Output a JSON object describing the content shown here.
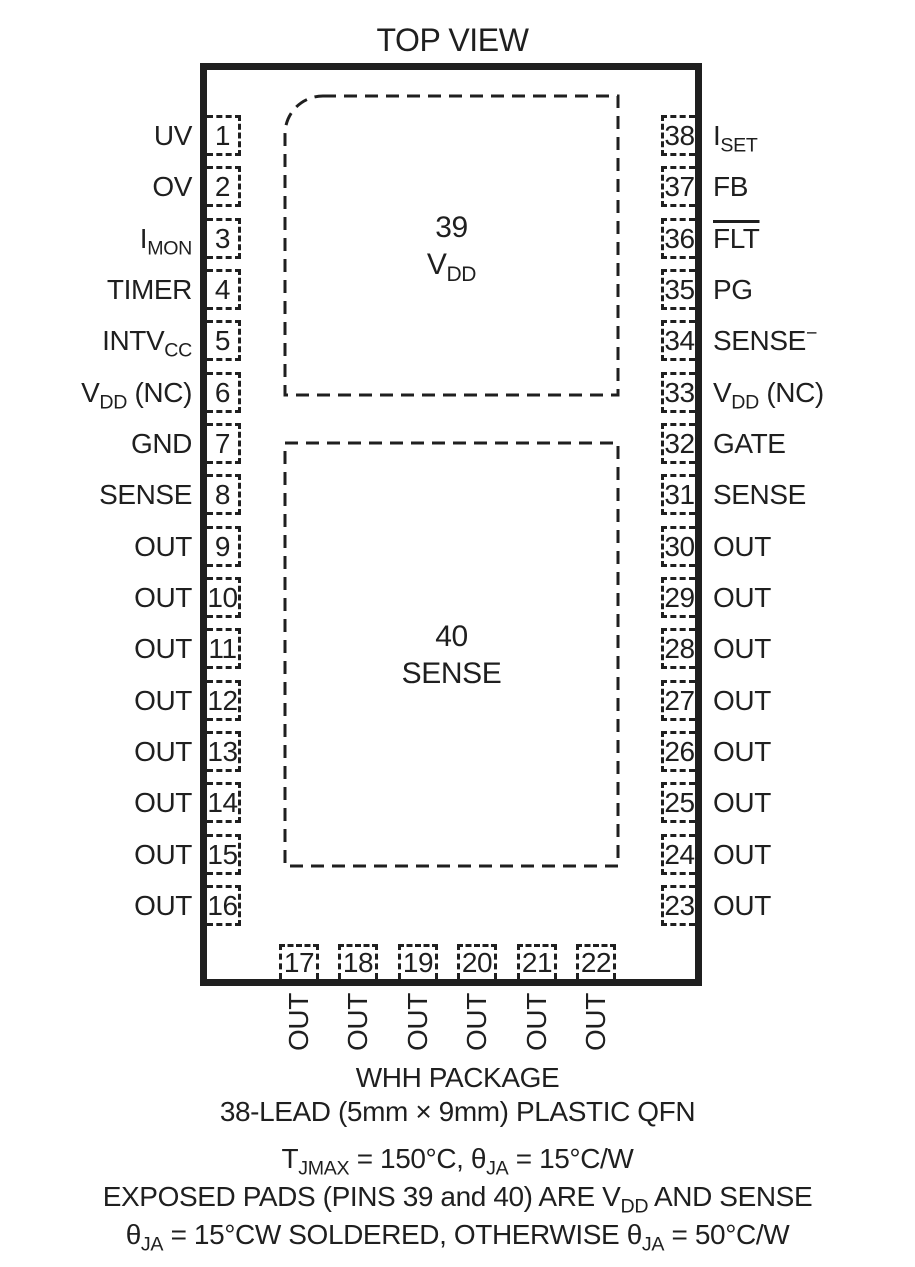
{
  "title": "TOP VIEW",
  "ink_color": "#1f1f1f",
  "pads": [
    {
      "num": "39",
      "label": {
        "main": "V",
        "sub": "DD"
      }
    },
    {
      "num": "40",
      "label": {
        "main": "SENSE"
      }
    }
  ],
  "pins": {
    "left": [
      {
        "num": "1",
        "label": {
          "main": "UV"
        }
      },
      {
        "num": "2",
        "label": {
          "main": "OV"
        }
      },
      {
        "num": "3",
        "label": {
          "main": "I",
          "sub": "MON"
        }
      },
      {
        "num": "4",
        "label": {
          "main": "TIMER"
        }
      },
      {
        "num": "5",
        "label": {
          "main": "INTV",
          "sub": "CC"
        }
      },
      {
        "num": "6",
        "label": {
          "main": "V",
          "sub": "DD",
          "suffix": " (NC)"
        }
      },
      {
        "num": "7",
        "label": {
          "main": "GND"
        }
      },
      {
        "num": "8",
        "label": {
          "main": "SENSE"
        }
      },
      {
        "num": "9",
        "label": {
          "main": "OUT"
        }
      },
      {
        "num": "10",
        "label": {
          "main": "OUT"
        }
      },
      {
        "num": "11",
        "label": {
          "main": "OUT"
        }
      },
      {
        "num": "12",
        "label": {
          "main": "OUT"
        }
      },
      {
        "num": "13",
        "label": {
          "main": "OUT"
        }
      },
      {
        "num": "14",
        "label": {
          "main": "OUT"
        }
      },
      {
        "num": "15",
        "label": {
          "main": "OUT"
        }
      },
      {
        "num": "16",
        "label": {
          "main": "OUT"
        }
      }
    ],
    "right": [
      {
        "num": "38",
        "label": {
          "main": "I",
          "sub": "SET"
        }
      },
      {
        "num": "37",
        "label": {
          "main": "FB"
        }
      },
      {
        "num": "36",
        "label": {
          "main": "FLT",
          "overline": true
        }
      },
      {
        "num": "35",
        "label": {
          "main": "PG"
        }
      },
      {
        "num": "34",
        "label": {
          "main": "SENSE",
          "sup": "−"
        }
      },
      {
        "num": "33",
        "label": {
          "main": "V",
          "sub": "DD",
          "suffix": " (NC)"
        }
      },
      {
        "num": "32",
        "label": {
          "main": "GATE"
        }
      },
      {
        "num": "31",
        "label": {
          "main": "SENSE"
        }
      },
      {
        "num": "30",
        "label": {
          "main": "OUT"
        }
      },
      {
        "num": "29",
        "label": {
          "main": "OUT"
        }
      },
      {
        "num": "28",
        "label": {
          "main": "OUT"
        }
      },
      {
        "num": "27",
        "label": {
          "main": "OUT"
        }
      },
      {
        "num": "26",
        "label": {
          "main": "OUT"
        }
      },
      {
        "num": "25",
        "label": {
          "main": "OUT"
        }
      },
      {
        "num": "24",
        "label": {
          "main": "OUT"
        }
      },
      {
        "num": "23",
        "label": {
          "main": "OUT"
        }
      }
    ],
    "bottom": [
      {
        "num": "17",
        "label": {
          "main": "OUT"
        }
      },
      {
        "num": "18",
        "label": {
          "main": "OUT"
        }
      },
      {
        "num": "19",
        "label": {
          "main": "OUT"
        }
      },
      {
        "num": "20",
        "label": {
          "main": "OUT"
        }
      },
      {
        "num": "21",
        "label": {
          "main": "OUT"
        }
      },
      {
        "num": "22",
        "label": {
          "main": "OUT"
        }
      }
    ]
  },
  "captions": {
    "package_line1": "WHH PACKAGE",
    "package_line2": "38-LEAD (5mm × 9mm) PLASTIC QFN",
    "thermal_line1": [
      "T",
      "JMAX",
      " = 150°C, θ",
      "JA",
      " = 15°C/W"
    ],
    "thermal_line2": [
      "EXPOSED PADS (PINS 39 and 40) ARE V",
      "DD",
      " AND SENSE"
    ],
    "thermal_line3": [
      "θ",
      "JA",
      " = 15°CW SOLDERED, OTHERWISE θ",
      "JA",
      " = 50°C/W"
    ]
  }
}
